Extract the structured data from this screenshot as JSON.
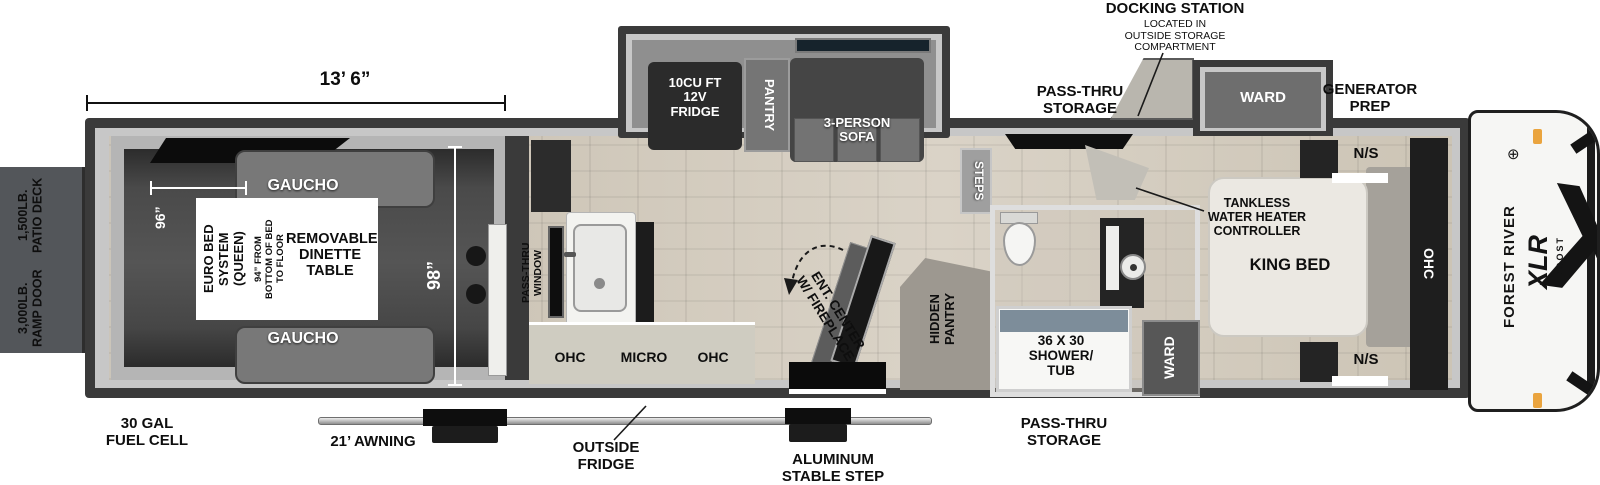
{
  "title": "Forest River XLR Boost toy hauler floorplan",
  "colors": {
    "wall": "#3a3a3a",
    "trim": "#c7c7c7",
    "garage_floor": "#474747",
    "wood_floor": "#d3ccc0",
    "counter": "#cfccc1",
    "shower_water": "#7d8d9a",
    "clearance_light_orange": "#eaa43e",
    "label_black": "#0e0e0e",
    "label_white": "#ffffff"
  },
  "dims": {
    "garage_length": "13’ 6”",
    "garage_width": "96”",
    "body_width": "98”"
  },
  "deck": {
    "patio": "1,500LB.\nPATIO DECK",
    "ramp": "3,000LB.\nRAMP DOOR"
  },
  "garage": {
    "gaucho_top": "GAUCHO",
    "gaucho_bottom": "GAUCHO",
    "euro_bed": "EURO BED\nSYSTEM\n(QUEEN)",
    "euro_note": "94” FROM\nBOTTOM OF BED\nTO FLOOR",
    "dinette": "REMOVABLE\nDINETTE\nTABLE"
  },
  "kitchen": {
    "pass_thru_window": "PASS-THRU\nWINDOW",
    "ohc_left": "OHC",
    "micro": "MICRO",
    "ohc_right": "OHC",
    "ent_center": "ENT. CENTER\nW/ FIREPLACE",
    "hidden_pantry": "HIDDEN\nPANTRY",
    "steps": "STEPS"
  },
  "slide": {
    "fridge": "10CU FT\n12V\nFRIDGE",
    "pantry": "PANTRY",
    "sofa": "3-PERSON\nSOFA",
    "ward": "WARD"
  },
  "bath": {
    "shower": "36 X 30\nSHOWER/\nTUB",
    "ward": "WARD"
  },
  "bedroom": {
    "tankless": "TANKLESS\nWATER HEATER\nCONTROLLER",
    "king_bed": "KING BED",
    "ns_top": "N/S",
    "ns_bottom": "N/S",
    "ohc": "OHC"
  },
  "top_callouts": {
    "docking_title": "DOCKING STATION",
    "docking_note": "LOCATED IN\nOUTSIDE STORAGE\nCOMPARTMENT",
    "pass_thru": "PASS-THRU\nSTORAGE",
    "generator": "GENERATOR\nPREP"
  },
  "bottom_callouts": {
    "fuel": "30 GAL\nFUEL CELL",
    "awning": "21’ AWNING",
    "outside_fridge": "OUTSIDE\nFRIDGE",
    "stable_step": "ALUMINUM\nSTABLE STEP",
    "pass_thru": "PASS-THRU\nSTORAGE"
  },
  "brand": {
    "maker": "FOREST RIVER",
    "model": "XLR",
    "sub": "BOOST",
    "x_graphic": "X",
    "logo_glyph": "⊕"
  }
}
